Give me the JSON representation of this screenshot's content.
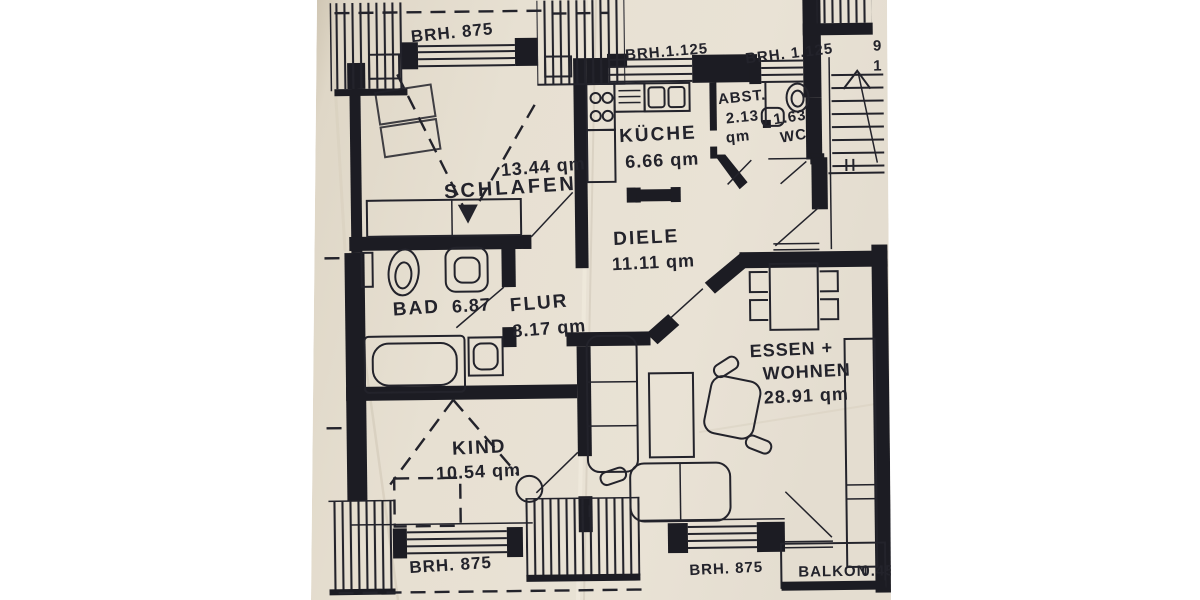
{
  "photo": {
    "background": "#ffffff",
    "paper_color": "#e6dfd1",
    "ink_color": "#23232b"
  },
  "rooms": [
    {
      "id": "schlafen",
      "name": "SCHLAFEN",
      "area": "13.44 qm"
    },
    {
      "id": "kueche",
      "name": "KÜCHE",
      "area": "6.66 qm"
    },
    {
      "id": "abstellraum",
      "name": "ABST.",
      "area_value": "2.13",
      "area_unit": "qm"
    },
    {
      "id": "wc",
      "name": "WC",
      "area": "1.63"
    },
    {
      "id": "diele",
      "name": "DIELE",
      "area": "11.11 qm"
    },
    {
      "id": "bad",
      "name": "BAD",
      "area": "6.87"
    },
    {
      "id": "flur",
      "name": "FLUR",
      "area": "8.17 qm"
    },
    {
      "id": "kind",
      "name": "KIND",
      "area": "10.54 qm"
    },
    {
      "id": "essen_wohnen",
      "name_line1": "ESSEN +",
      "name_line2": "WOHNEN",
      "area": "28.91 qm"
    },
    {
      "id": "balkon",
      "name": "BALKON",
      "area": "0.45"
    }
  ],
  "annotations": {
    "brh_top_left": "BRH. 875",
    "brh_top_center": "BRH.1.125",
    "brh_top_right": "BRH. 1.125",
    "brh_bottom_left": "BRH. 875",
    "brh_bottom_center": "BRH. 875",
    "edge_digit_top": "9",
    "edge_digit_bottom": "1"
  }
}
